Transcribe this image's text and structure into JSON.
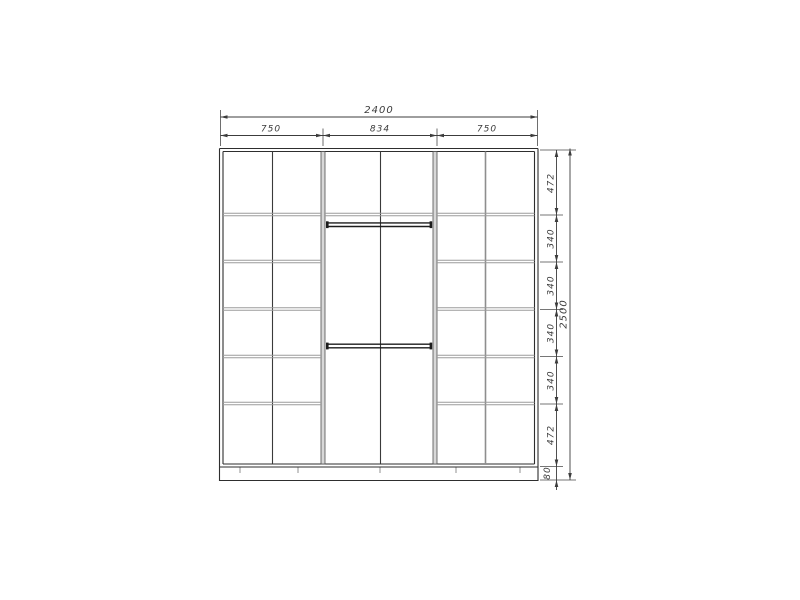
{
  "drawing": {
    "type": "wardrobe-front-elevation",
    "colors": {
      "background": "#ffffff",
      "outline": "#2e2e2e",
      "shelf_lines": "#9b9b9b",
      "partition_fill": "#d8d8d8",
      "rail": "#1c1c1c",
      "dimension_lines": "#3c3c3c"
    }
  },
  "dimensions": {
    "total_width": "2400",
    "top_segments": [
      "750",
      "834",
      "750"
    ],
    "total_height": "2500",
    "right_segments": [
      "472",
      "340",
      "340",
      "340",
      "340",
      "472"
    ],
    "plinth_height": "80"
  }
}
